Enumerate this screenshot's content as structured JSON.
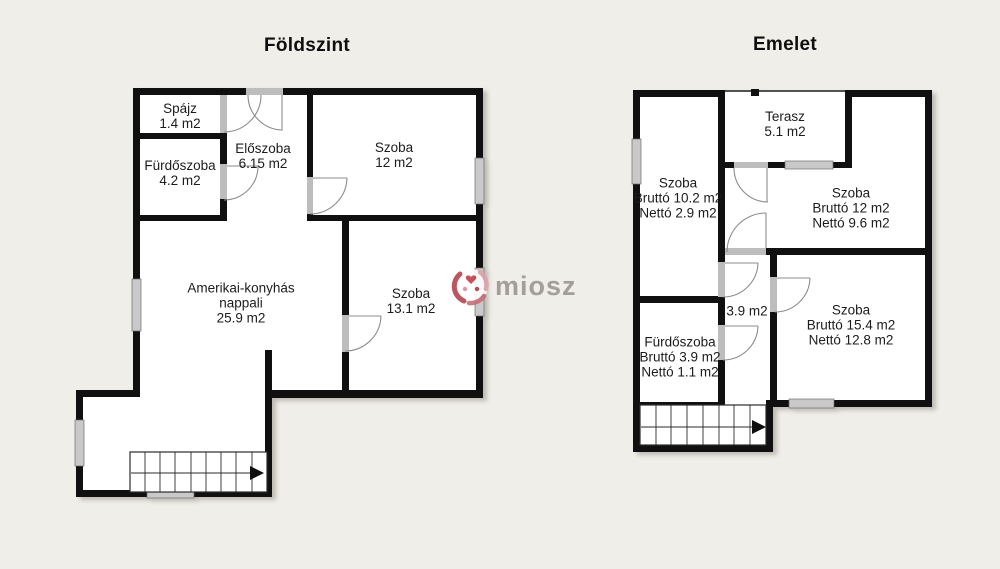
{
  "watermark": {
    "text": "miosz"
  },
  "floors": [
    {
      "title": "Földszint",
      "rooms": [
        {
          "name": "Spájz",
          "area": "1.4 m2"
        },
        {
          "name": "Fürdőszoba",
          "area": "4.2 m2"
        },
        {
          "name": "Előszoba",
          "area": "6.15 m2"
        },
        {
          "name": "Szoba",
          "area": "12 m2"
        },
        {
          "name": "Amerikai-konyhás",
          "line2": "nappali",
          "area": "25.9 m2"
        },
        {
          "name": "Szoba",
          "area": "13.1 m2"
        }
      ]
    },
    {
      "title": "Emelet",
      "rooms": [
        {
          "name": "Terasz",
          "area": "5.1 m2"
        },
        {
          "name": "Szoba",
          "area": "Bruttó 10.2 m2",
          "area2": "Nettó 2.9 m2"
        },
        {
          "name": "Szoba",
          "area": "Bruttó 12 m2",
          "area2": "Nettó 9.6 m2"
        },
        {
          "name": "",
          "area": "3.9 m2"
        },
        {
          "name": "Szoba",
          "area": "Bruttó 15.4 m2",
          "area2": "Nettó 12.8 m2"
        },
        {
          "name": "Fürdőszoba",
          "area": "Bruttó 3.9 m2",
          "area2": "Nettó 1.1 m2"
        }
      ]
    }
  ]
}
